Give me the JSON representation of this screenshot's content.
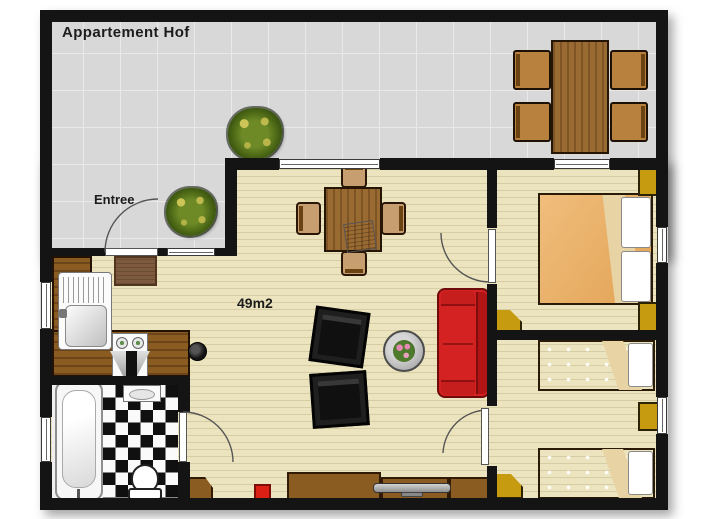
{
  "title": "Appartement Hof",
  "labels": {
    "entrance": "Entree",
    "area": "49m2"
  },
  "colors": {
    "wall": "#141414",
    "terrace_floor": "#d8d8d8",
    "interior_floor": "#ece4bf",
    "counter_wood": "#8a5c22",
    "table_wood": "#9a6a33",
    "chair_wood": "#c79e70",
    "bed_blanket": "#e8ab5f",
    "bed_flap": "#e8d3a4",
    "pillow_white": "#ffffff",
    "nightstand_gold": "#c79b10",
    "sofa_red": "#d42222",
    "armchair_black": "#1f1f1f",
    "checker_black": "#101010",
    "tub_white": "#f7f7f7",
    "tv_gray": "#a9a9a9",
    "plant_green": "#4a6b17",
    "stool_red": "#dd2015",
    "side_table_gray": "#bdbdbd"
  }
}
